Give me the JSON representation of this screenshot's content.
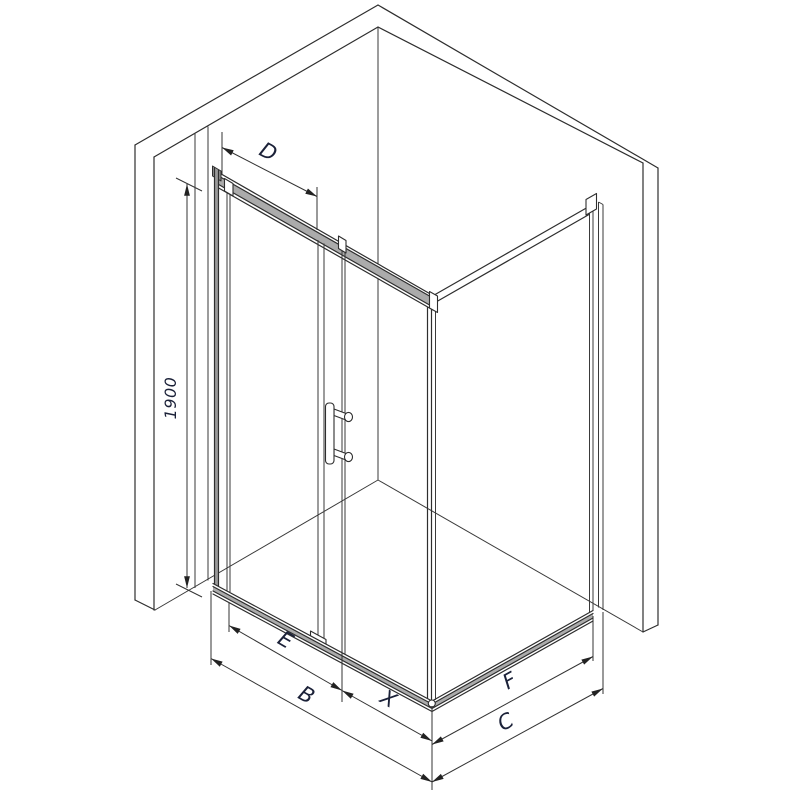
{
  "drawing": {
    "type": "isometric-technical-drawing",
    "subject": "corner shower enclosure with sliding door and fixed side panel",
    "labels": {
      "d": "D",
      "height": "1900",
      "e": "E",
      "b": "B",
      "x": "X",
      "f": "F",
      "c": "C"
    },
    "colors": {
      "line": "#2e2e2e",
      "dimension_line": "#333333",
      "label_text": "#1b2138",
      "profile_fill": "#ababab",
      "background": "#ffffff"
    }
  }
}
